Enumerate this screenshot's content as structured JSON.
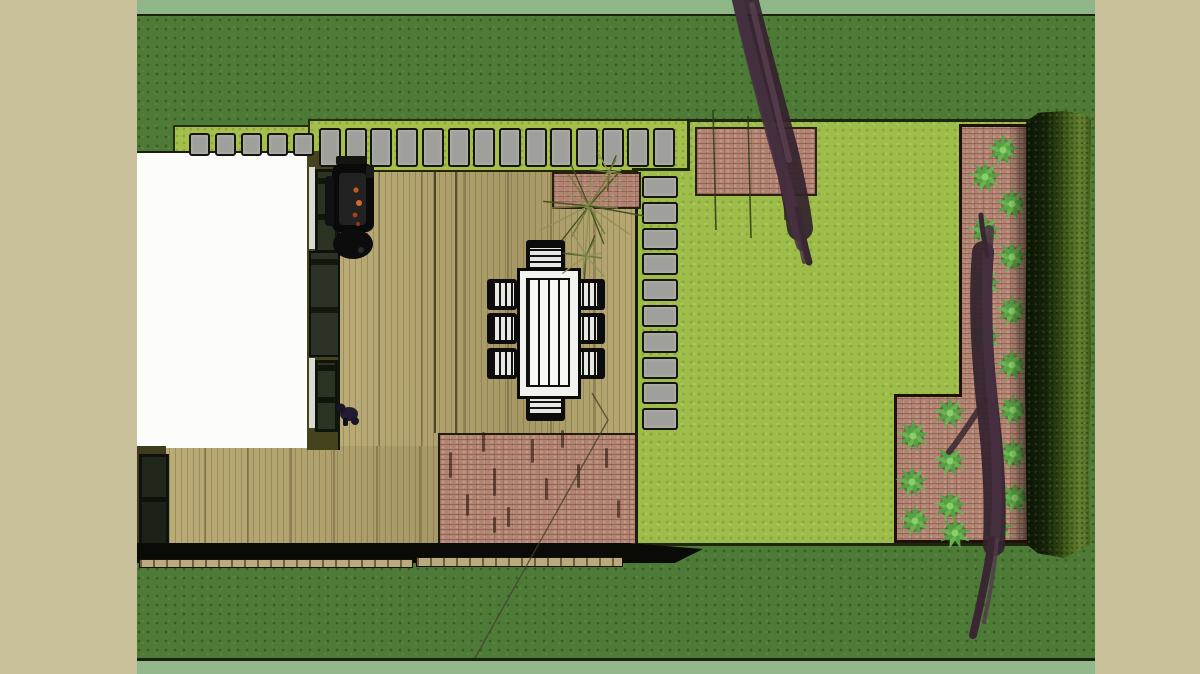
{
  "viewport": {
    "description": "Top-down 3D landscape / garden design render",
    "margin_color": "#c8c09b"
  },
  "palette": {
    "grass_dark": "#4e7a37",
    "grass_edge_strip": "#8fb687",
    "lawn_bright": "#9dbc49",
    "path_bed_lime": "#a4bf4a",
    "paver_gray": "#9fa09b",
    "deck_wood": "#b3a46d",
    "brick": "#b08373",
    "hedge_dark": "#16230a",
    "hedge_light": "#648130",
    "shrub_green": "#55a244",
    "tree_canopy": "#33222e",
    "house_white": "#fcfcfa",
    "wall_olive": "#45431e",
    "table_white": "#f2f2ee",
    "frame_black": "#0c0c0c",
    "ember_orange": "#c25a1e"
  },
  "counts": {
    "stepping_stones_top": 19,
    "stepping_stones_side": 10,
    "dining_chairs": 8,
    "shrubs": 20,
    "trees": 2
  },
  "design": {
    "pavers": [
      {
        "x": 52,
        "y": 133,
        "w": 17,
        "h": 19,
        "pitch": 26,
        "count": 5,
        "dir": "h"
      },
      {
        "x": 182,
        "y": 128,
        "w": 18,
        "h": 35,
        "pitch": 25.7,
        "count": 14,
        "dir": "h"
      },
      {
        "x": 505,
        "y": 176,
        "w": 32,
        "h": 18,
        "pitch": 25.8,
        "count": 10,
        "dir": "v"
      }
    ],
    "shrubs": [
      [
        866,
        150
      ],
      [
        848,
        177
      ],
      [
        875,
        204
      ],
      [
        848,
        231
      ],
      [
        875,
        257
      ],
      [
        848,
        284
      ],
      [
        875,
        311
      ],
      [
        848,
        338
      ],
      [
        875,
        365
      ],
      [
        813,
        413
      ],
      [
        776,
        436
      ],
      [
        876,
        410
      ],
      [
        813,
        461
      ],
      [
        775,
        482
      ],
      [
        876,
        454
      ],
      [
        813,
        506
      ],
      [
        778,
        521
      ],
      [
        878,
        498
      ],
      [
        818,
        533
      ],
      [
        860,
        528
      ]
    ],
    "chairs": [
      [
        389,
        240,
        39,
        30,
        "top"
      ],
      [
        389,
        391,
        39,
        30,
        "bottom"
      ],
      [
        350,
        279,
        30,
        31,
        "left"
      ],
      [
        350,
        313,
        30,
        31,
        "left"
      ],
      [
        350,
        348,
        30,
        31,
        "left"
      ],
      [
        438,
        279,
        30,
        31,
        "right"
      ],
      [
        438,
        313,
        30,
        31,
        "right"
      ],
      [
        438,
        348,
        30,
        31,
        "right"
      ]
    ],
    "patio_dashes": [
      [
        310,
        450,
        26
      ],
      [
        327,
        492,
        22
      ],
      [
        343,
        430,
        20
      ],
      [
        354,
        466,
        28
      ],
      [
        368,
        505,
        20
      ],
      [
        392,
        437,
        24
      ],
      [
        406,
        476,
        22
      ],
      [
        354,
        515,
        16
      ],
      [
        422,
        428,
        18
      ],
      [
        438,
        462,
        24
      ],
      [
        466,
        446,
        20
      ],
      [
        478,
        498,
        18
      ]
    ],
    "tufts": [
      {
        "cx": 452,
        "cy": 208,
        "r": 58,
        "n": 18
      },
      {
        "cx": 472,
        "cy": 174,
        "r": 26,
        "n": 11
      },
      {
        "cx": 449,
        "cy": 258,
        "r": 32,
        "n": 11
      }
    ],
    "stems": [
      [
        576,
        110,
        120
      ],
      [
        611,
        116,
        122
      ],
      [
        645,
        112,
        108
      ]
    ]
  }
}
